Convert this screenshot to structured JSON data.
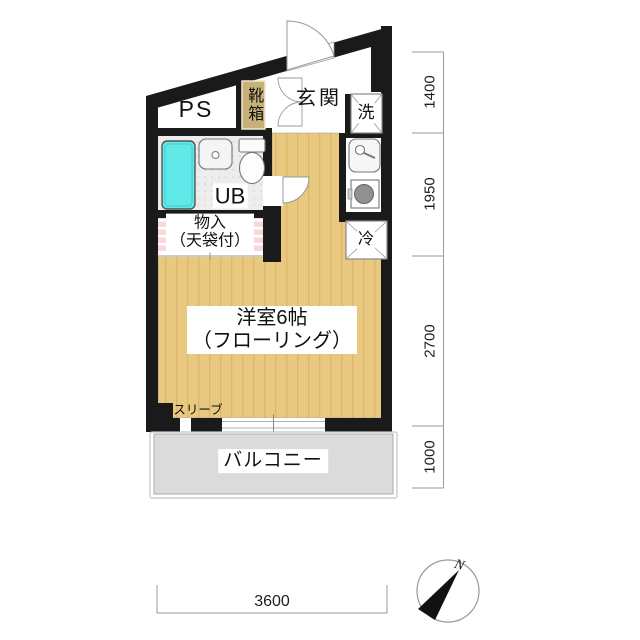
{
  "plan": {
    "labels": {
      "ps": "PS",
      "shoe_box": "靴箱",
      "entrance": "玄関",
      "laundry": "洗",
      "unit_bath": "UB",
      "closet_line1": "物入",
      "closet_line2": "（天袋付）",
      "fridge": "冷",
      "main_room_line1": "洋室6帖",
      "main_room_line2": "（フローリング）",
      "sleeve": "スリーブ",
      "balcony": "バルコニー"
    },
    "dimensions_mm": {
      "right": [
        "1400",
        "1950",
        "2700",
        "1000"
      ],
      "bottom": "3600"
    },
    "compass": {
      "north": "N"
    },
    "colors": {
      "wall": "#1a1a1a",
      "room_floor": "#E9C87F",
      "floor_stripe": "#DDB76C",
      "bathtub": "#5FE8E8",
      "closet_fill": "#F9D8DB",
      "shoe_box_fill": "#C8B179",
      "balcony_fill": "#DBDBDB",
      "ub_floor": "#EDEDED"
    }
  }
}
